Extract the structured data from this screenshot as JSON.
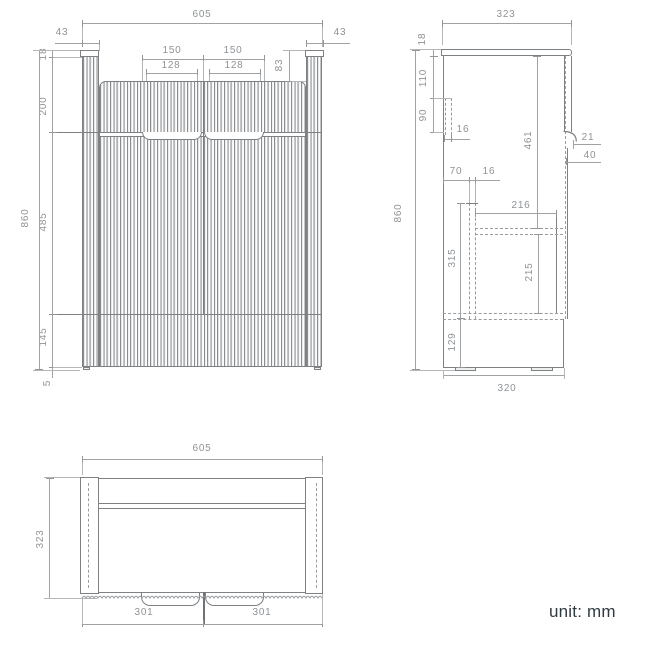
{
  "unit_note": "unit: mm",
  "front_view": {
    "overall_width": "605",
    "left_side_width": "43",
    "right_side_width": "43",
    "left_handle_outer": "150",
    "right_handle_outer": "150",
    "left_handle_inner": "128",
    "right_handle_inner": "128",
    "top_recess_depth": "83",
    "overall_height": "860",
    "worktop_thickness": "18",
    "upper_section_height": "200",
    "door_section_height": "485",
    "lower_section_height": "145",
    "foot_height": "5"
  },
  "side_view": {
    "overall_depth": "323",
    "worktop_thickness": "18",
    "bracket_offset": "110",
    "bracket_height": "90",
    "bracket_thickness": "16",
    "overall_height": "860",
    "divider_offset": "70",
    "divider_thickness": "16",
    "upper_interior_height": "461",
    "handle_recess_depth": "21",
    "handle_recess_height": "40",
    "shelf_depth": "216",
    "divider_height": "315",
    "under_shelf_height": "215",
    "bottom_offset": "129",
    "base_depth": "320"
  },
  "bottom_view": {
    "overall_width": "605",
    "overall_depth": "323",
    "left_door_width": "301",
    "right_door_width": "301"
  }
}
